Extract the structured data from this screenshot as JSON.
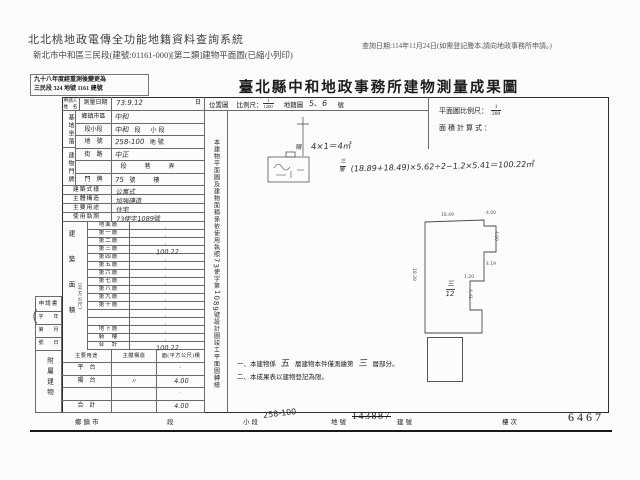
{
  "colors": {
    "paper": "#fcfcfc",
    "ink": "#1c1c1c",
    "table_line": "#6a6a6a",
    "handwriting": "#2e2e38"
  },
  "header": {
    "system_title": "北北桃地政電傳全功能地籍資料查詢系統",
    "print_note": "查詢日期:114年11月24日(如需登記謄本,請向地政事務所申請。)",
    "subtitle": "新北市中和區三民段(建號:01161-000)[第二類]建物平面圖(已縮小列印)"
  },
  "document": {
    "remark_line1": "九十八年度經重測後變更為",
    "remark_line2": "三民段 324 地號 1161 建號",
    "title": "臺北縣中和地政事務所建物測量成果圖"
  },
  "left_table": {
    "applicant_line1": "申請人",
    "applicant_line2": "姓　名",
    "survey_label": "測量日期",
    "survey_hand": "73.9.12",
    "survey_suffix": "日",
    "site_group": "基地坐落",
    "door_group": "建物門牌",
    "site_door_rows": [
      {
        "label": "鄉鎮市區",
        "hand": "中和",
        "printed": ""
      },
      {
        "label": "段小段",
        "hand": "中和",
        "printed": "段　小段"
      },
      {
        "label": "地　號",
        "hand": "258-100",
        "printed": "地號"
      },
      {
        "label": "街　路",
        "hand": "中正",
        "printed": ""
      },
      {
        "label": "",
        "hand": "",
        "printed": "段　　巷　　弄"
      },
      {
        "label": "門　牌",
        "hand": "75",
        "printed": "號　　樓"
      }
    ],
    "attr_rows": [
      {
        "label": "建築式樣",
        "hand": "公寓式"
      },
      {
        "label": "主體構造",
        "hand": "加強磚造"
      },
      {
        "label": "主要用途",
        "hand": "住宅"
      },
      {
        "label": "使用執照",
        "hand": "73使字1089號"
      }
    ],
    "floor_group": "建築面積",
    "floor_unit": "（平方公尺）",
    "floors": [
      {
        "label": "地面層",
        "dot": "·",
        "hand": ""
      },
      {
        "label": "第一層",
        "dot": "·",
        "hand": ""
      },
      {
        "label": "第二層",
        "dot": "·",
        "hand": ""
      },
      {
        "label": "第三層",
        "dot": "",
        "hand": "100.22"
      },
      {
        "label": "第四層",
        "dot": "·",
        "hand": ""
      },
      {
        "label": "第五層",
        "dot": "·",
        "hand": ""
      },
      {
        "label": "第六層",
        "dot": "·",
        "hand": ""
      },
      {
        "label": "第七層",
        "dot": "·",
        "hand": ""
      },
      {
        "label": "第八層",
        "dot": "·",
        "hand": ""
      },
      {
        "label": "第九層",
        "dot": "·",
        "hand": ""
      },
      {
        "label": "第十層",
        "dot": "·",
        "hand": ""
      },
      {
        "label": "",
        "dot": "·",
        "hand": ""
      },
      {
        "label": "",
        "dot": "·",
        "hand": ""
      },
      {
        "label": "地下層",
        "dot": "·",
        "hand": ""
      },
      {
        "label": "騎　樓",
        "dot": "·",
        "hand": ""
      },
      {
        "label": "合　計",
        "dot": "",
        "hand": "100.22"
      }
    ],
    "annex_header": [
      "主要用途",
      "主體構造",
      "面(平方公尺)積"
    ],
    "annex_rows": [
      {
        "use": "平　台",
        "struct": "",
        "dot": "·",
        "hand": ""
      },
      {
        "use": "陽　台",
        "struct": "〃",
        "dot": "",
        "hand": "4.00"
      },
      {
        "use": "",
        "struct": "",
        "dot": "·",
        "hand": ""
      },
      {
        "use": "合　計",
        "struct": "",
        "dot": "",
        "hand": "4.00"
      }
    ]
  },
  "request_box": {
    "title": "申請書",
    "rows": [
      "字　　年",
      "第　　月",
      "號　　日"
    ],
    "annex_group": "附屬建物"
  },
  "mid": {
    "loc_label": "位置圖",
    "scale_label": "比例尺：",
    "num": "1",
    "den": "1200",
    "cad_label": "地籍圖",
    "cad_hand": "5、6",
    "cad_suffix": "號"
  },
  "vtext": {
    "pre": "本建物平面圖及建物面積係依使用執照",
    "hand1": "73",
    "mid": "使字第",
    "hand2": "1089",
    "post": "號設計圖竣工平面圖轉繪"
  },
  "plan": {
    "scale_label": "平面圖比例尺：",
    "num": "1",
    "den": "200",
    "calc_label": "面積計算式：",
    "unit_num": "三",
    "unit_den": "12",
    "dims": [
      {
        "t": "18.49",
        "x": 441,
        "y": 213
      },
      {
        "t": "4.00",
        "x": 486,
        "y": 211
      },
      {
        "t": "4.00",
        "x": 498,
        "y": 231,
        "rot": 90
      },
      {
        "t": "4.19",
        "x": 486,
        "y": 262
      },
      {
        "t": "1.20",
        "x": 464,
        "y": 275
      },
      {
        "t": "4.41",
        "x": 472,
        "y": 289,
        "rot": 90
      },
      {
        "t": "18.39",
        "x": 416,
        "y": 268,
        "rot": 90
      }
    ]
  },
  "calc": {
    "c1_prefix": "陽",
    "c1": "4×1＝4㎡",
    "c2_num": "三",
    "c2_den": "層",
    "c2": "(18.89+18.49)×5.62÷2−1.2×5.41＝100.22㎡"
  },
  "notes": {
    "n1a": "一、本建物係",
    "n1h1": "五",
    "n1b": "層建物本件僅測繪第",
    "n1h2": "三",
    "n1c": "層部分。",
    "n2": "二、本成果表以建物登記為限。"
  },
  "footer": {
    "township": "鄉鎮市",
    "section": "段",
    "subsection": "小段",
    "parcel_hand": "258-100",
    "parcel": "地號",
    "old_building_no": "143887",
    "building": "建號",
    "floor_label": "樓次",
    "sheet_no": "6467"
  },
  "stray_mark": "（"
}
